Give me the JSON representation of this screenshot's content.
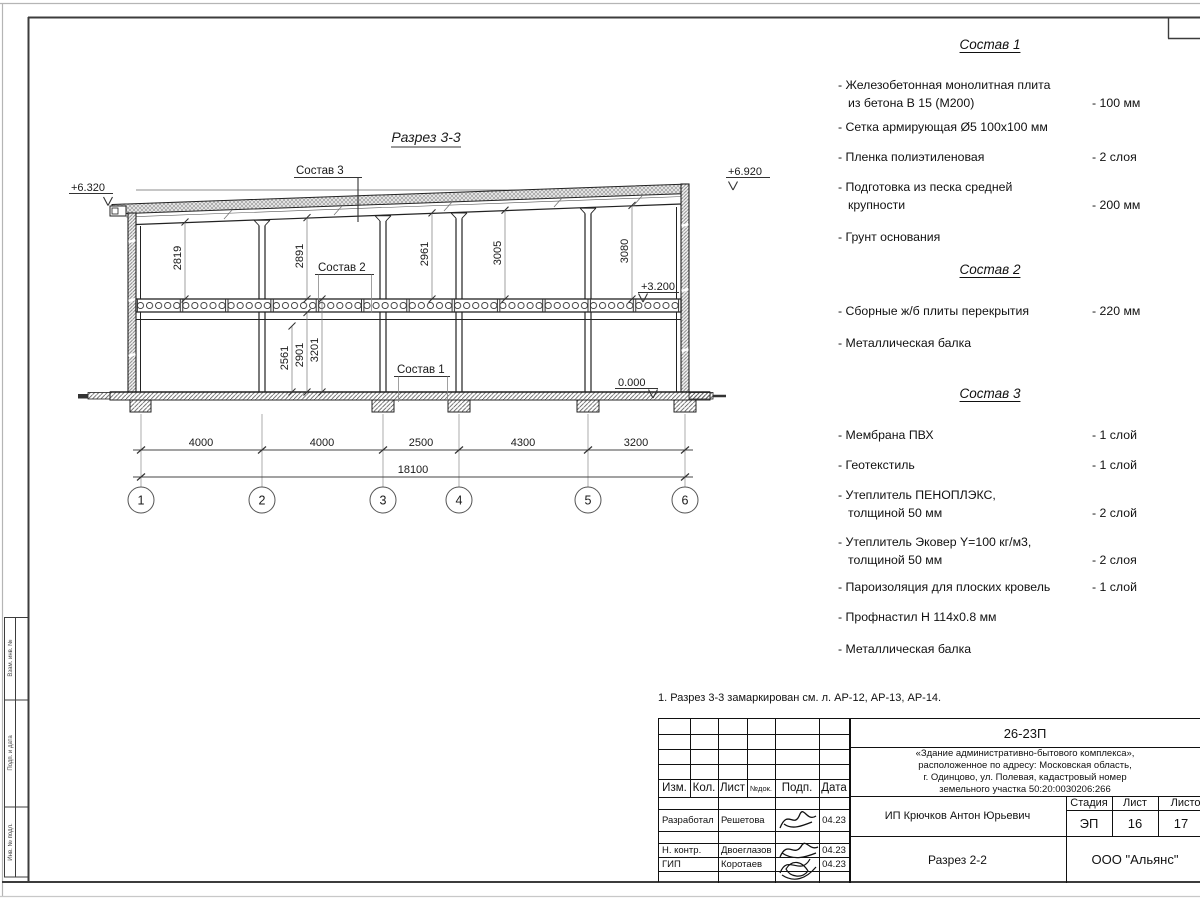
{
  "sheet": {
    "section_title": "Разрез 3-3",
    "note": "1. Разрез 3-3 замаркирован см. л. АР-12, АР-13, АР-14."
  },
  "drawing": {
    "labels": {
      "comp3": "Состав 3",
      "comp2": "Состав 2",
      "comp1": "Состав 1"
    },
    "elevations": {
      "roof_left": "+6.320",
      "roof_right": "+6.920",
      "floor2": "+3.200",
      "ground": "0.000"
    },
    "dims_floor2": [
      "2819",
      "2891",
      "2961",
      "3005",
      "3080"
    ],
    "dims_floor1": [
      "2561",
      "2901",
      "3201"
    ],
    "dims_spans": [
      "4000",
      "4000",
      "2500",
      "4300",
      "3200"
    ],
    "dim_total": "18100",
    "axes": [
      "1",
      "2",
      "3",
      "4",
      "5",
      "6"
    ]
  },
  "compositions": [
    {
      "title": "Состав 1",
      "items": [
        {
          "name": "- Железобетонная  монолитная плита\nиз бетона В 15 (М200)",
          "value": "- 100 мм"
        },
        {
          "name": "- Сетка армирующая Ø5 100x100 мм",
          "value": ""
        },
        {
          "name": "- Пленка полиэтиленовая",
          "value": "-  2 слоя"
        },
        {
          "name": "- Подготовка из песка средней\nкрупности",
          "value": "- 200 мм"
        },
        {
          "name": "- Грунт основания",
          "value": ""
        }
      ]
    },
    {
      "title": "Состав 2",
      "items": [
        {
          "name": "- Сборные ж/б плиты перекрытия",
          "value": "- 220 мм"
        },
        {
          "name": "- Металлическая балка",
          "value": ""
        }
      ]
    },
    {
      "title": "Состав 3",
      "items": [
        {
          "name": "- Мембрана ПВХ",
          "value": "- 1 слой"
        },
        {
          "name": "- Геотекстиль",
          "value": "- 1 слой"
        },
        {
          "name": "- Утеплитель ПЕНОПЛЭКС,\nтолщиной 50 мм",
          "value": "- 2 слой"
        },
        {
          "name": "- Утеплитель Эковер Y=100 кг/м3,\nтолщиной 50 мм",
          "value": "- 2 слоя"
        },
        {
          "name": "- Пароизоляция для плоских кровель",
          "value": "- 1 слой"
        },
        {
          "name": "- Профнастил Н 114x0.8 мм",
          "value": ""
        },
        {
          "name": "- Металлическая балка",
          "value": ""
        }
      ]
    }
  ],
  "titleblock": {
    "doc_number": "26-23П",
    "project": "«Здание административно-бытового комплекса»,\nрасположенное по адресу: Московская область,\nг. Одинцово, ул. Полевая, кадастровый номер\nземельного участка 50:20:0030206:266",
    "client": "ИП Крючков Антон Юрьевич",
    "sheet_name": "Разрез 2-2",
    "company": "ООО \"Альянс\"",
    "stage_header": "Стадия",
    "sheet_header": "Лист",
    "sheets_header": "Листов",
    "stage": "ЭП",
    "sheet_no": "16",
    "sheets_total": "17",
    "cols": [
      "Изм.",
      "Кол.",
      "Лист",
      "№док.",
      "Подп.",
      "Дата"
    ],
    "rows": [
      {
        "role": "Разработал",
        "name": "Решетова",
        "date": "04.23"
      },
      {
        "role": "Н. контр.",
        "name": "Двоеглазов",
        "date": "04.23"
      },
      {
        "role": "ГИП",
        "name": "Коротаев",
        "date": "04.23"
      }
    ]
  },
  "margin_labels": [
    "Взам. инв. №",
    "Подп. и дата",
    "Инв. № подл."
  ]
}
